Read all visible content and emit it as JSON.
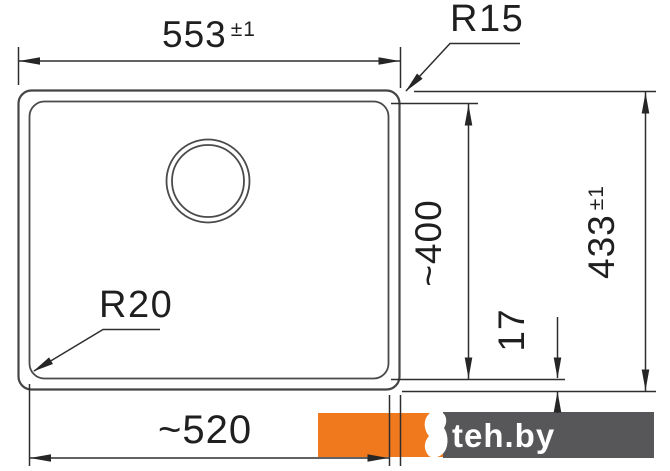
{
  "drawing": {
    "title": "sink-dimension-drawing",
    "dimensions": {
      "top_width": {
        "value": "553",
        "tolerance": "±1"
      },
      "right_height": {
        "value": "433",
        "tolerance": "±1"
      },
      "bowl_depth": {
        "value": "~400"
      },
      "rim_offset": {
        "value": "17"
      },
      "bottom_width": {
        "value": "~520"
      },
      "radius_outer": {
        "value": "R15"
      },
      "radius_inner": {
        "value": "R20"
      }
    }
  },
  "watermark": {
    "label": "teh.by",
    "orange": "#F0791E",
    "gray": "#57575A"
  },
  "colors": {
    "background": "#ffffff",
    "line": "#2e2e2e",
    "text": "#1f1f1f"
  }
}
